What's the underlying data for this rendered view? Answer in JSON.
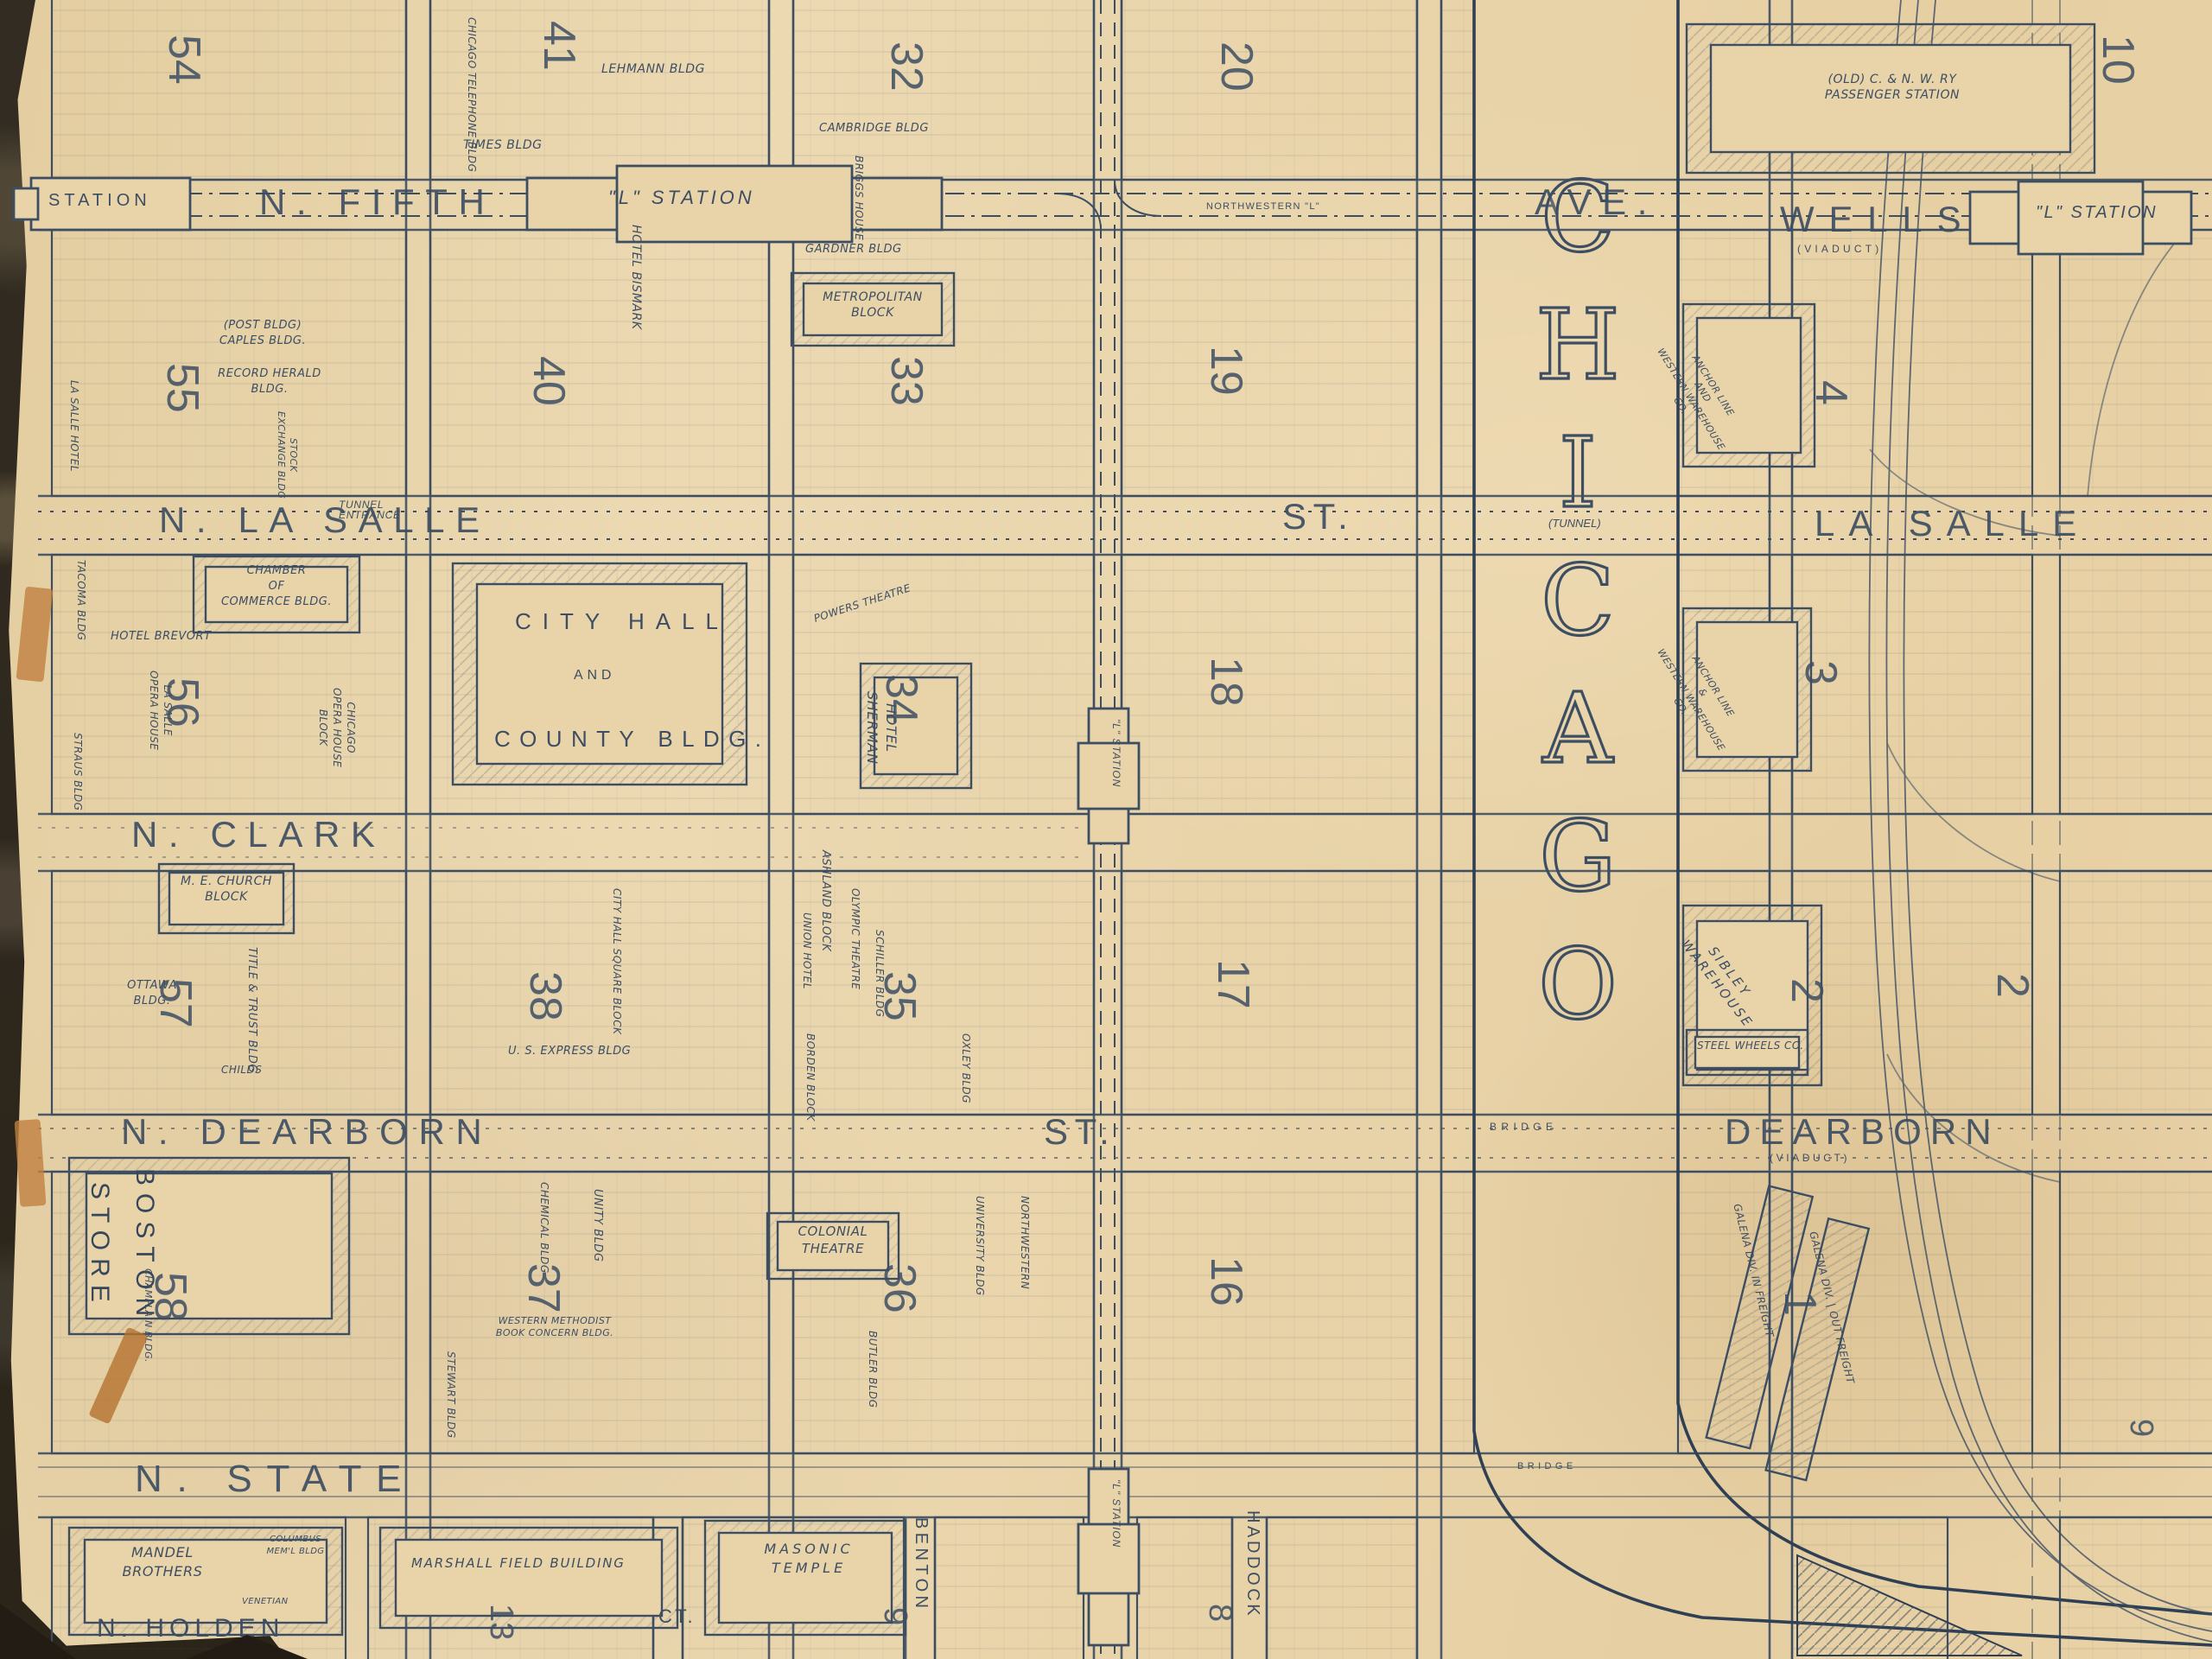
{
  "photo": {
    "background_color": "#332c22",
    "tape_color": "#c08040"
  },
  "map": {
    "paper_color": "#e9d4aa",
    "ink_color": "#3d4e63",
    "streets": {
      "station": "STATION",
      "n_fifth": "N. FIFTH",
      "l_station": "\"L\" STATION",
      "northwestern_l": "NORTHWESTERN \"L\"",
      "ave": "AVE.",
      "wells": "WELLS",
      "wells_note": "(VIADUCT)",
      "tunnel_entrance": "TUNNEL\nENTRANCE",
      "n_la_salle": "N. LA SALLE",
      "lasalle_st": "ST.",
      "tunnel_note": "(TUNNEL)",
      "la_salle_east": "LA SALLE",
      "n_clark": "N. CLARK",
      "n_dearborn": "N. DEARBORN",
      "dearborn_st": "ST.",
      "bridge": "BRIDGE",
      "dearborn_east": "DEARBORN",
      "dearborn_note": "(VIADUCT)",
      "n_state": "N. STATE",
      "state_bridge": "BRIDGE",
      "n_holden": "N. HOLDEN",
      "holden_ct": "CT.",
      "benton": "BENTON",
      "haddock": "HADDOCK",
      "l_station_v1": "\"L\" STATION",
      "l_station_v2": "\"L\" STATION"
    },
    "river": {
      "letters": [
        "C",
        "H",
        "I",
        "C",
        "A",
        "G",
        "O"
      ]
    },
    "block_numbers": {
      "b54": "54",
      "b41": "41",
      "b32": "32",
      "b20": "20",
      "b10": "10",
      "b55": "55",
      "b40": "40",
      "b33": "33",
      "b19": "19",
      "b56": "56",
      "b34": "34",
      "b18": "18",
      "e4": "4",
      "e3": "3",
      "b57": "57",
      "b38": "38",
      "b35": "35",
      "b17": "17",
      "e2": "2",
      "e2b": "2",
      "b58": "58",
      "b37": "37",
      "b36": "36",
      "b16": "16",
      "e1": "1",
      "b13": "13",
      "b9": "9",
      "b8": "8",
      "e9": "9"
    },
    "buildings": {
      "chicago_telephone": "CHICAGO TELEPHONE BLDG",
      "lehmann": "LEHMANN BLDG",
      "times": "TIMES BLDG",
      "cambridge": "CAMBRIDGE BLDG",
      "post_caples": "(POST BLDG)\nCAPLES BLDG.",
      "record_herald": "RECORD HERALD\nBLDG.",
      "stock_exchange": "STOCK\nEXCHANGE BLDG",
      "lasalle_hotel": "LA SALLE HOTEL",
      "hotel_bismark": "HOTEL BISMARK",
      "briggs_house": "BRIGGS HOUSE",
      "gardner": "GARDNER BLDG",
      "metropolitan": "METROPOLITAN\nBLOCK",
      "tacoma": "TACOMA BLDG",
      "chamber": "CHAMBER\nOF\nCOMMERCE BLDG.",
      "hotel_brevort": "HOTEL BREVORT",
      "lasalle_opera": "LA SALLE\nOPERA HOUSE",
      "straus": "STRAUS BLDG",
      "chicago_opera": "CHICAGO\nOPERA HOUSE\nBLOCK",
      "city_hall": "CITY HALL",
      "city_hall_and": "AND",
      "county_bldg": "COUNTY BLDG.",
      "powers": "POWERS THEATRE",
      "hotel_sherman": "HOTEL\nSHERMAN",
      "me_church": "M. E. CHURCH\nBLOCK",
      "title_trust": "TITLE & TRUST BLDG",
      "ottawa": "OTTAWA\nBLDG.",
      "childs": "CHILDS",
      "city_hall_square": "CITY HALL SQUARE BLOCK",
      "us_express": "U. S. EXPRESS BLDG",
      "ashland": "ASHLAND BLOCK",
      "union_hotel": "UNION HOTEL",
      "olympic": "OLYMPIC THEATRE",
      "schiller": "SCHILLER BLDG",
      "borden": "BORDEN BLOCK",
      "oxley": "OXLEY BLDG",
      "boston": "BOSTON",
      "store": "STORE",
      "champlain": "CHAMPLAIN BLDG.",
      "chemical": "CHEMICAL BLDG",
      "unity": "UNITY BLDG",
      "western_methodist": "WESTERN METHODIST\nBOOK CONCERN BLDG.",
      "stewart": "STEWART BLDG",
      "colonial": "COLONIAL\nTHEATRE",
      "university": "UNIVERSITY BLDG",
      "northwestern_u": "NORTHWESTERN",
      "butler": "BUTLER BLDG",
      "mandel": "MANDEL\nBROTHERS",
      "columbus": "COLUMBUS\nMEM'L BLDG",
      "venetian": "VENETIAN",
      "marshall_field": "MARSHALL FIELD BUILDING",
      "masonic": "MASONIC\nTEMPLE",
      "cnw_station": "(OLD) C. & N. W. RY\nPASSENGER STATION",
      "anchor_line_1": "ANCHOR LINE\nAND\nWESTERN WAREHOUSE CO.",
      "anchor_line_2": "ANCHOR LINE\n&\nWESTERN WAREHOUSE CO.",
      "sibley": "SIBLEY\nWAREHOUSE",
      "steel_wheels": "STEEL WHEELS CO.",
      "galena_in": "GALENA DIV. IN FREIGHT",
      "galena_out": "GALENA DIV. | OUT FREIGHT"
    }
  }
}
